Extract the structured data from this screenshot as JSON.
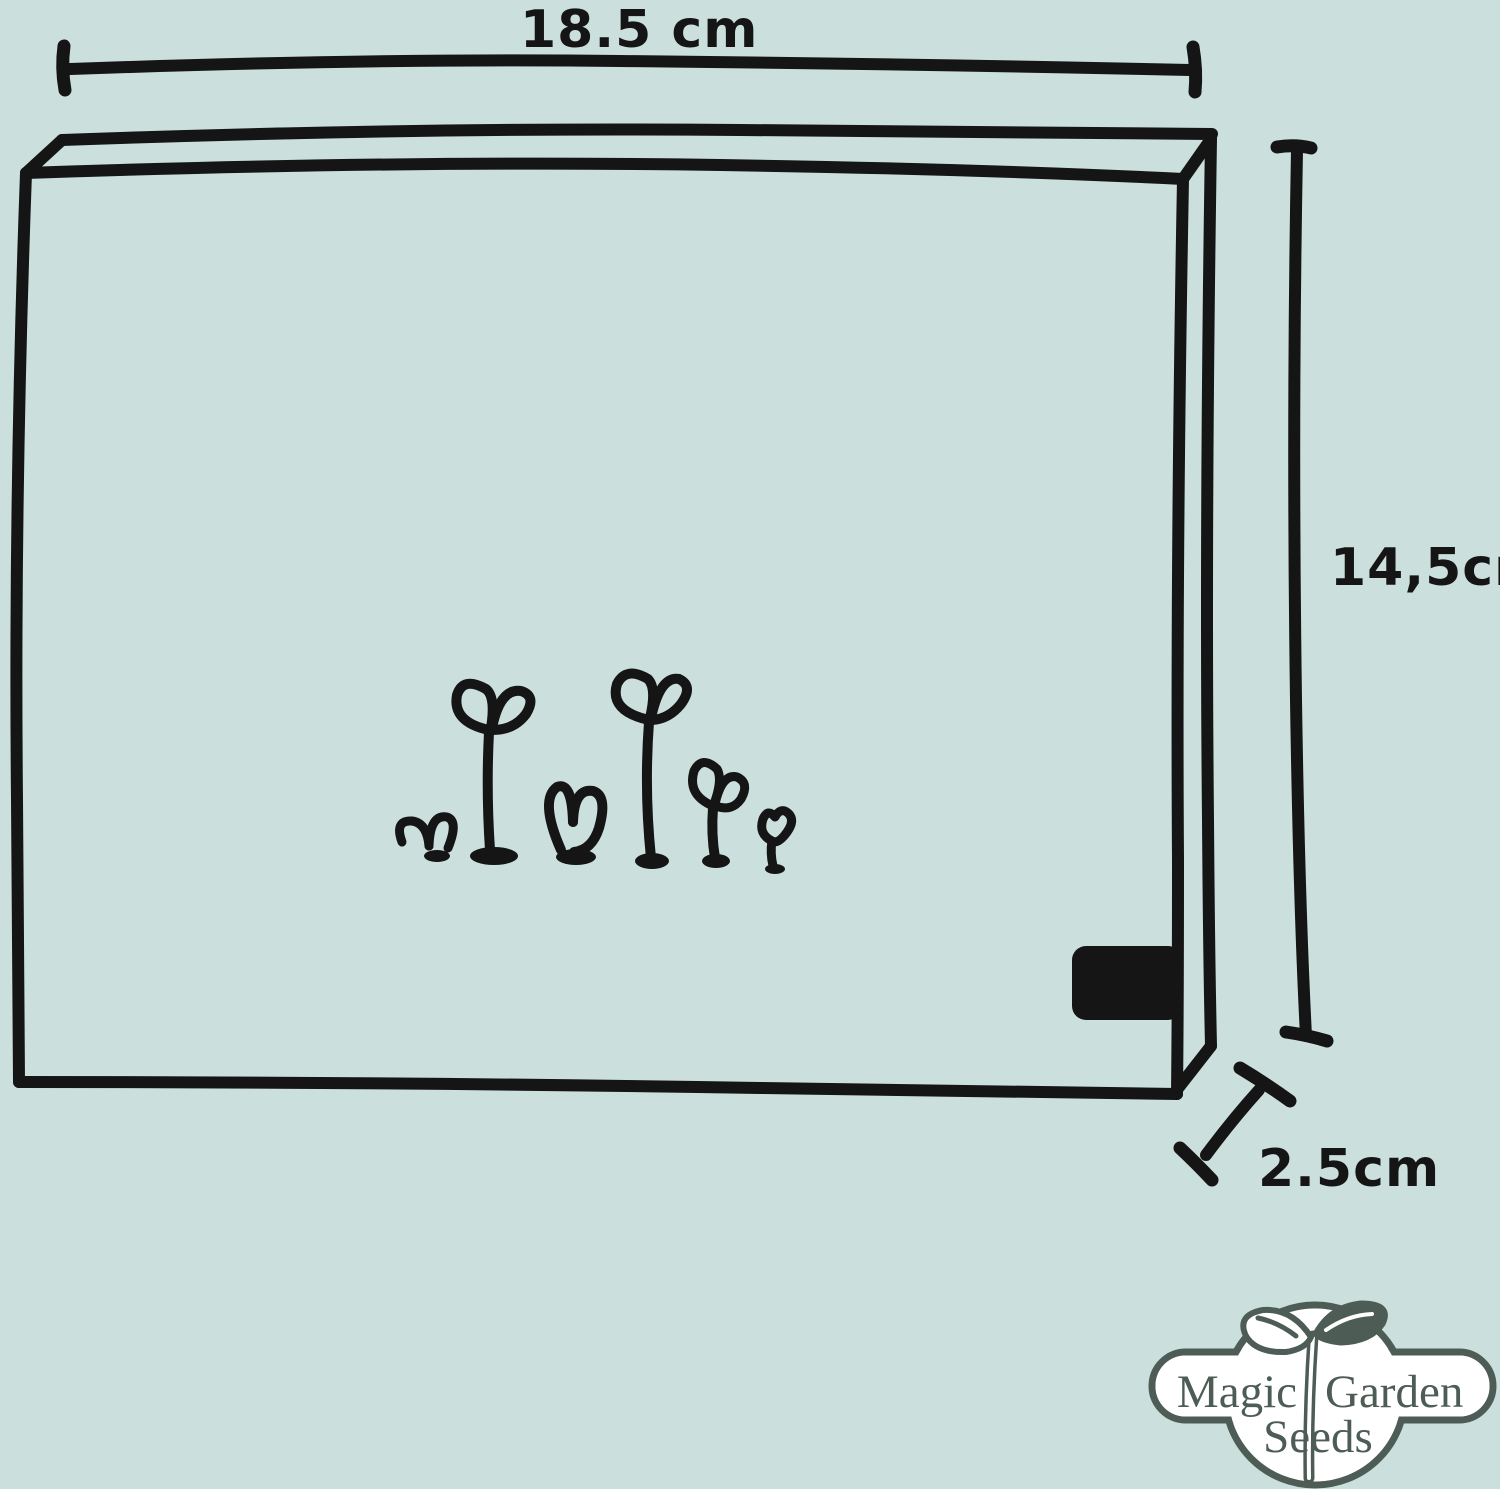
{
  "diagram": {
    "width_label": "18.5 cm",
    "height_label": "14,5cm",
    "depth_label": "2.5cm"
  },
  "logo": {
    "word_left": "Magic",
    "word_right": "Garden",
    "word_bottom": "Seeds"
  },
  "colors": {
    "background": "#cbe0dc",
    "ink": "#151515",
    "logo_green": "#4d5d56",
    "logo_fill": "#ffffff"
  }
}
